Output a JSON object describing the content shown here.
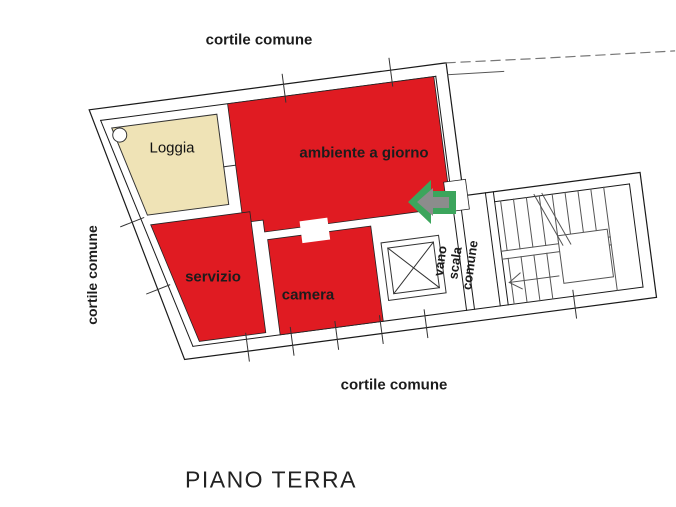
{
  "plan": {
    "title": "PIANO TERRA",
    "labels": {
      "courtyard_top": "cortile comune",
      "courtyard_left": "cortile comune",
      "courtyard_bottom": "cortile comune",
      "stairwell": [
        "vano",
        "scala",
        "comune"
      ]
    },
    "rooms": {
      "loggia": {
        "label": "Loggia",
        "color": "#efe3b6"
      },
      "living": {
        "label": "ambiente a giorno",
        "color": "#e01b22"
      },
      "service": {
        "label": "servizio",
        "color": "#e01b22"
      },
      "bedroom": {
        "label": "camera",
        "color": "#e01b22"
      }
    },
    "colors": {
      "room_red": "#e01b22",
      "loggia_beige": "#efe3b6",
      "arrow_green": "#3ca55c",
      "arrow_gray": "#8c8c8c",
      "wall_line": "#1a1a1a",
      "stair_line": "#555555"
    },
    "entrance_arrow": {
      "direction": "left"
    }
  }
}
